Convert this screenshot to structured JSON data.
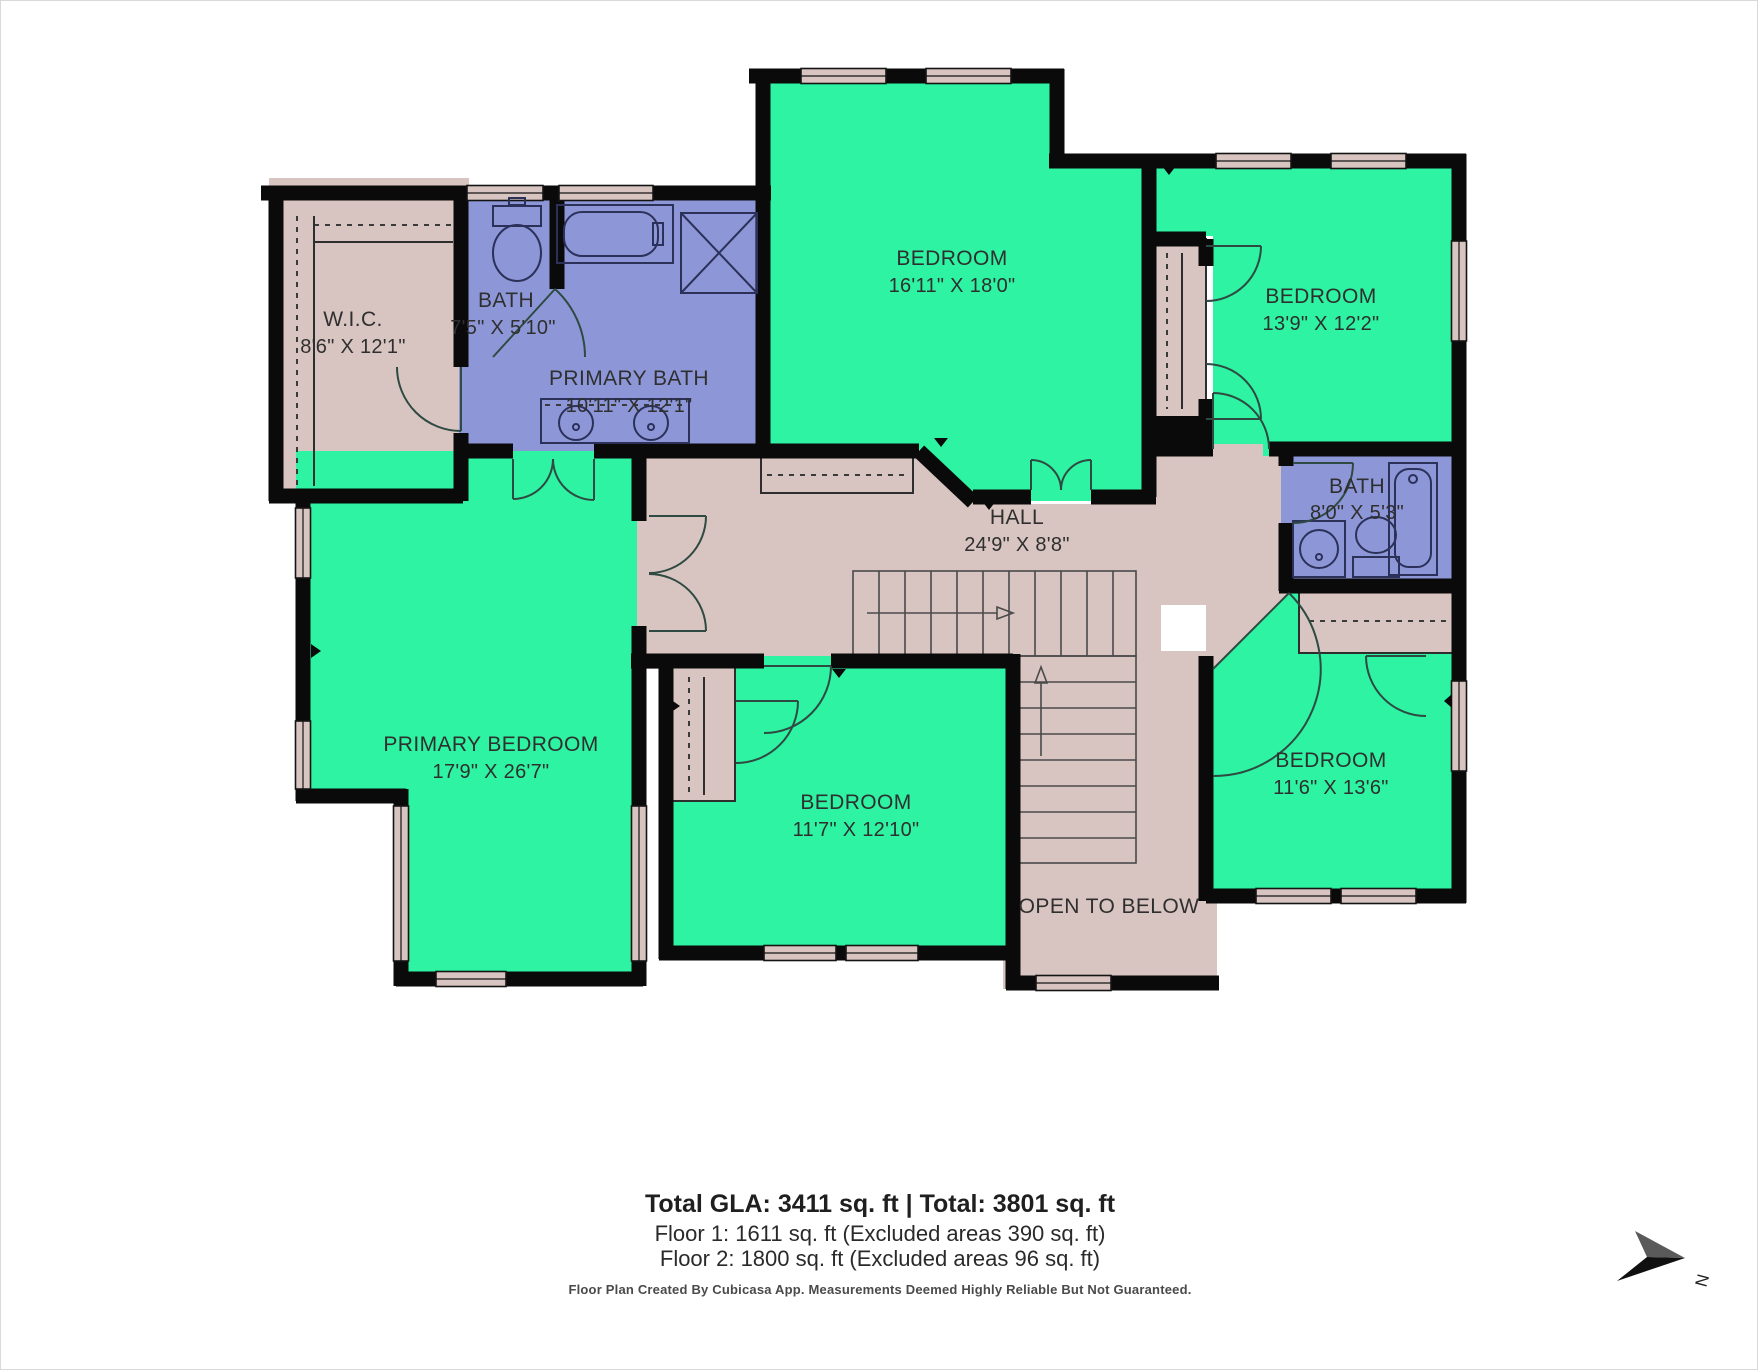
{
  "plan": {
    "rooms": [
      {
        "id": "wic",
        "name": "W.I.C.",
        "dims": "8'6\" X 12'1\""
      },
      {
        "id": "bath_small",
        "name": "BATH",
        "dims": "7'5\" X 5'10\""
      },
      {
        "id": "primary_bath",
        "name": "PRIMARY BATH",
        "dims": "10'11\" X 12'1\""
      },
      {
        "id": "bedroom_top_center",
        "name": "BEDROOM",
        "dims": "16'11\" X 18'0\""
      },
      {
        "id": "bedroom_top_right",
        "name": "BEDROOM",
        "dims": "13'9\" X 12'2\""
      },
      {
        "id": "bath_right",
        "name": "BATH",
        "dims": "8'0\" X 5'3\""
      },
      {
        "id": "hall",
        "name": "HALL",
        "dims": "24'9\" X 8'8\""
      },
      {
        "id": "primary_bedroom",
        "name": "PRIMARY BEDROOM",
        "dims": "17'9\" X 26'7\""
      },
      {
        "id": "bedroom_bottom_center",
        "name": "BEDROOM",
        "dims": "11'7\" X 12'10\""
      },
      {
        "id": "bedroom_bottom_right",
        "name": "BEDROOM",
        "dims": "11'6\" X 13'6\""
      }
    ],
    "open_to_below": "OPEN TO BELOW",
    "compass_label": "N"
  },
  "footer": {
    "gla_line": "Total GLA: 3411 sq. ft | Total: 3801 sq. ft",
    "floor1_line": "Floor 1: 1611 sq. ft (Excluded areas 390 sq. ft)",
    "floor2_line": "Floor 2: 1800 sq. ft (Excluded areas 96 sq. ft)",
    "disclaimer": "Floor Plan Created By Cubicasa App. Measurements Deemed Highly Reliable But Not Guaranteed."
  },
  "colors": {
    "room_green": "#2df3a2",
    "room_purple": "#8d97d8",
    "room_tan": "#d8c5c1",
    "wall": "#0a0a0a"
  }
}
